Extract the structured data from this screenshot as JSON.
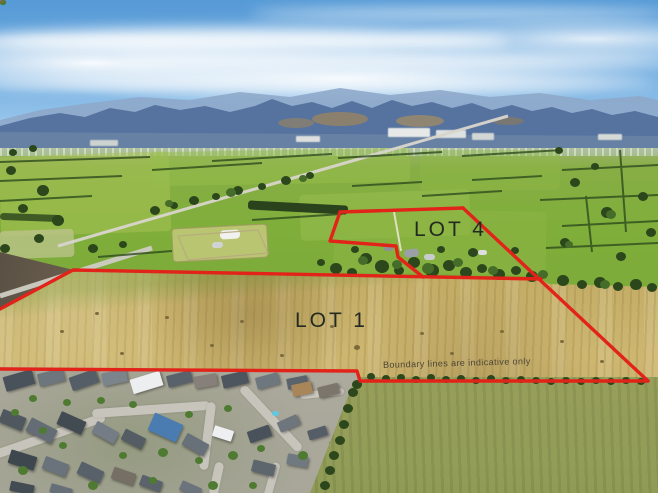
{
  "scene": {
    "type": "aerial-drone-photograph",
    "subject": "Rural land parcels outlined in red over farmland, with mountains behind and a residential subdivision in the foreground"
  },
  "labels": {
    "lot1": "LOT 1",
    "lot4": "LOT 4",
    "disclaimer": "Boundary lines are indicative only"
  },
  "colors": {
    "boundary": "#e2231a",
    "lot_label_text": "#232a22",
    "disclaimer_text": "#4a4434",
    "sky": "#6ca9de",
    "mountains": "#56729f",
    "farmland": "#7fae3a",
    "lot1_field": "#c9b169",
    "foreground_field": "#a2a061",
    "residential_roofs": "#5a626a"
  }
}
